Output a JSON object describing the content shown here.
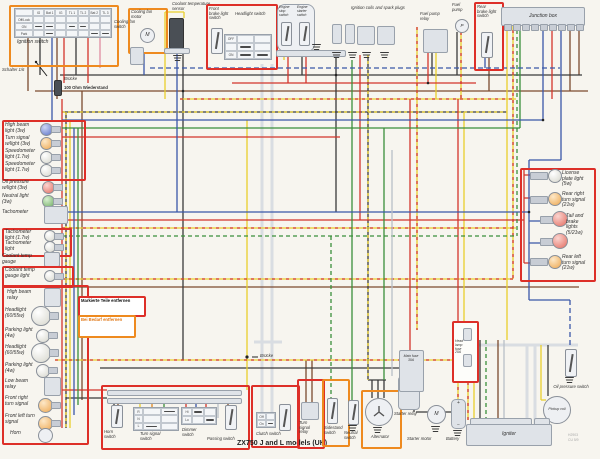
{
  "caption": "ZX750 J and L models (UK)",
  "footnote": {
    "line1": "H2903",
    "line2": "CU 5/9"
  },
  "annotations": {
    "schalter": "Schalter 1/6",
    "bruecke": "Brücke",
    "widerstand": "100 Ohm Wiederstand",
    "bruecke_mid": "Brücke",
    "markierte": "Markierte Teile entfernen",
    "bei_bedarf": "Bei Bedarf entfernen"
  },
  "labels": {
    "ignition_switch": "Ignition switch",
    "cooling_fan_switch": "Cooling fan switch",
    "cooling_fan_motor": "Cooling fan motor",
    "coolant_temp_sensor": "Coolant temperature sensor",
    "front_brake_light_switch": "Front brake light switch",
    "headlight_switch": "Headlight switch",
    "engine_stop_switch": "Engine stop switch",
    "engine_starter_switch": "Engine starter switch",
    "ignition_coils": "Ignition coils and spark plugs",
    "fuel_pump_relay": "Fuel pump relay",
    "fuel_pump": "Fuel pump",
    "rear_brake_light_switch": "Rear brake light switch",
    "junction_box": "Junction box",
    "high_beam_light": "High beam light (3w)",
    "turn_signal_wlight": "Turn signal w/light (3w)",
    "speedometer_light1": "Speedometer light (1.7w)",
    "speedometer_light2": "Speedometer light (1.7w)",
    "oil_pressure_wlight": "Oil pressure w/light (3w)",
    "neutral_light": "Neutral light (3w)",
    "tachometer": "Tachometer",
    "tachometer_light1": "Tachometer light (1.7w)",
    "tachometer_light2": "Tachometer light",
    "coolant_temp_gauge": "Coolant temp gauge",
    "coolant_temp_gauge_light": "Coolant temp gauge light",
    "high_beam_relay": "High beam relay",
    "headlight1": "Headlight (60/55w)",
    "parking_light1": "Parking light (4w)",
    "headlight2": "Headlight (60/55w)",
    "parking_light2": "Parking light (4w)",
    "low_beam_relay": "Low beam relay",
    "front_right_turn_signal": "Front right turn signal",
    "front_left_turn_signal": "Front left turn signal",
    "horn": "Horn",
    "license_plate_light": "License plate light (5w)",
    "rear_right_turn_signal": "Rear right turn signal (21w)",
    "tail_brake_lights": "Tail and brake lights (5/21w)",
    "rear_left_turn_signal": "Rear left turn signal (21w)",
    "horn_switch": "Horn switch",
    "turn_signal_switch": "Turn signal switch",
    "dimmer_switch": "Dimmer switch",
    "passing_switch": "Passing switch",
    "clutch_switch": "Clutch switch",
    "turn_signal_relay": "Turn signal relay",
    "sidestand_switch": "Sidestand switch",
    "neutral_switch": "Neutral switch",
    "alternator": "Alternator",
    "starter_relay": "Starter relay",
    "starter_motor": "Starter motor",
    "battery": "Battery",
    "main_fuse": "Main fuse 30A",
    "headlamp_fuse": "Head lamp fuse 20A",
    "oil_pressure_switch": "Oil pressure switch",
    "pickup_coil": "Pickup coil",
    "igniter": "Igniter"
  },
  "glyphs": {
    "motor": "M",
    "pump": "P",
    "starter": "M",
    "plus": "+",
    "minus": "−"
  },
  "tables": {
    "ignition": {
      "columns": [
        "IG",
        "Bat 1",
        "IG",
        "TL 1",
        "TL 2",
        "Bat 2",
        "TL 3"
      ],
      "rows": [
        "Off/Lock",
        "ON",
        "Park"
      ]
    },
    "headlight": {
      "rows": [
        "OFF",
        "",
        "ON"
      ]
    },
    "turn_signal": {
      "rows": [
        "R",
        "N",
        "L"
      ]
    },
    "dimmer": {
      "rows": [
        "Hi",
        "Lo"
      ]
    },
    "clutch": {
      "rows": [
        "Off",
        "On"
      ]
    }
  },
  "colors": {
    "box_red": "#dd2f28",
    "box_orange": "#ee8a1f",
    "wire_red": "#d3352b",
    "wire_yellow": "#e9cf2b",
    "wire_green": "#3a8f3a",
    "wire_blue": "#3a57a8",
    "wire_brown": "#7b4a2e",
    "wire_black": "#3a3a3a",
    "component_fill": "#dfe3e8",
    "paper": "#f7f5ef"
  }
}
